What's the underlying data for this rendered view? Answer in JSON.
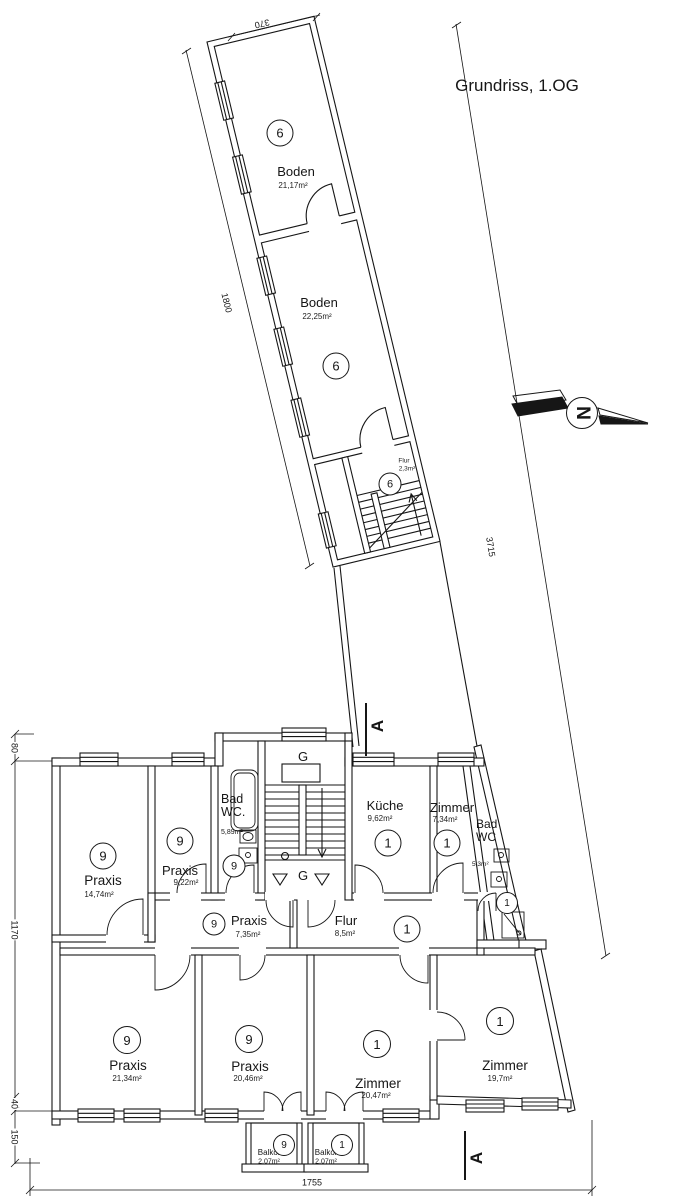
{
  "title": "Grundriss, 1.OG",
  "north": {
    "label": "N"
  },
  "section": {
    "label": "A"
  },
  "stairwell": {
    "label_top": "G",
    "label_bottom": "G"
  },
  "attic": {
    "rooms": [
      {
        "unit": "6",
        "name": "Boden",
        "area": "21,17m²"
      },
      {
        "unit": "6",
        "name": "Boden",
        "area": "22,25m²"
      },
      {
        "unit": "6",
        "name": "Flur",
        "area": "2,3m²"
      }
    ]
  },
  "floor": {
    "rooms": [
      {
        "unit": "9",
        "name": "Praxis",
        "area": "14,74m²"
      },
      {
        "unit": "9",
        "name": "Praxis",
        "area": "9,22m²"
      },
      {
        "unit": "9",
        "name": "Bad WC.",
        "area": "5,89m²"
      },
      {
        "unit": "9",
        "name": "Praxis",
        "area": "7,35m²"
      },
      {
        "unit": "1",
        "name": "Küche",
        "area": "9,62m²"
      },
      {
        "unit": "1",
        "name": "Zimmer",
        "area": "7,34m²"
      },
      {
        "unit": "1",
        "name": "Bad WC",
        "area": "5,3m²"
      },
      {
        "unit": "1",
        "name": "Flur",
        "area": "8,5m²"
      },
      {
        "unit": "9",
        "name": "Praxis",
        "area": "21,34m²"
      },
      {
        "unit": "9",
        "name": "Praxis",
        "area": "20,46m²"
      },
      {
        "unit": "1",
        "name": "Zimmer",
        "area": "20,47m²"
      },
      {
        "unit": "1",
        "name": "Zimmer",
        "area": "19,7m²"
      },
      {
        "unit": "9",
        "name": "Balkon",
        "area": "2,07m²"
      },
      {
        "unit": "1",
        "name": "Balkon",
        "area": "2,07m²"
      }
    ]
  },
  "dimensions": {
    "top": "370",
    "wing_left": "1800",
    "right_diagonal": "3715",
    "left_top": "80",
    "left_main": "1170",
    "left_step": "40",
    "left_balcony": "150",
    "bottom": "1755"
  },
  "colors": {
    "line": "#161616",
    "background": "#ffffff"
  }
}
